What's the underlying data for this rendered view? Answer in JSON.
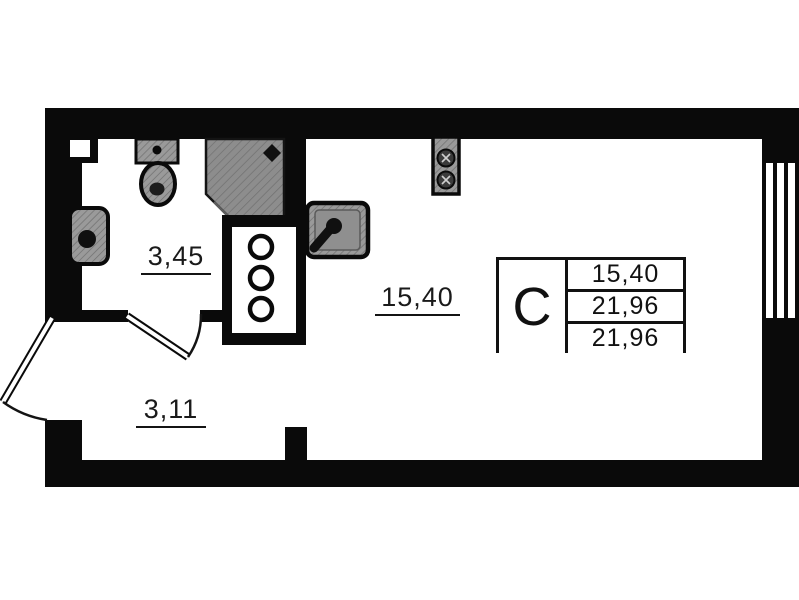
{
  "plan_title": "studio-floor-plan",
  "rooms": {
    "bathroom": {
      "area": "3,45"
    },
    "hallway": {
      "area": "3,11"
    },
    "living_kitchen": {
      "area": "15,40"
    }
  },
  "legend": {
    "unit_type": "С",
    "rows": [
      "15,40",
      "21,96",
      "21,96"
    ]
  },
  "fixtures": [
    "toilet",
    "wash-basin",
    "shower-cabin",
    "utility-shaft",
    "kitchen-sink",
    "stove-two-burners",
    "window",
    "entrance-door",
    "bathroom-door"
  ],
  "colors": {
    "wall": "#0a0a0a",
    "fixture_gray": "#9a9a9a",
    "shower_gray": "#8d8d8d",
    "background": "#ffffff",
    "text": "#1a1a1a"
  }
}
